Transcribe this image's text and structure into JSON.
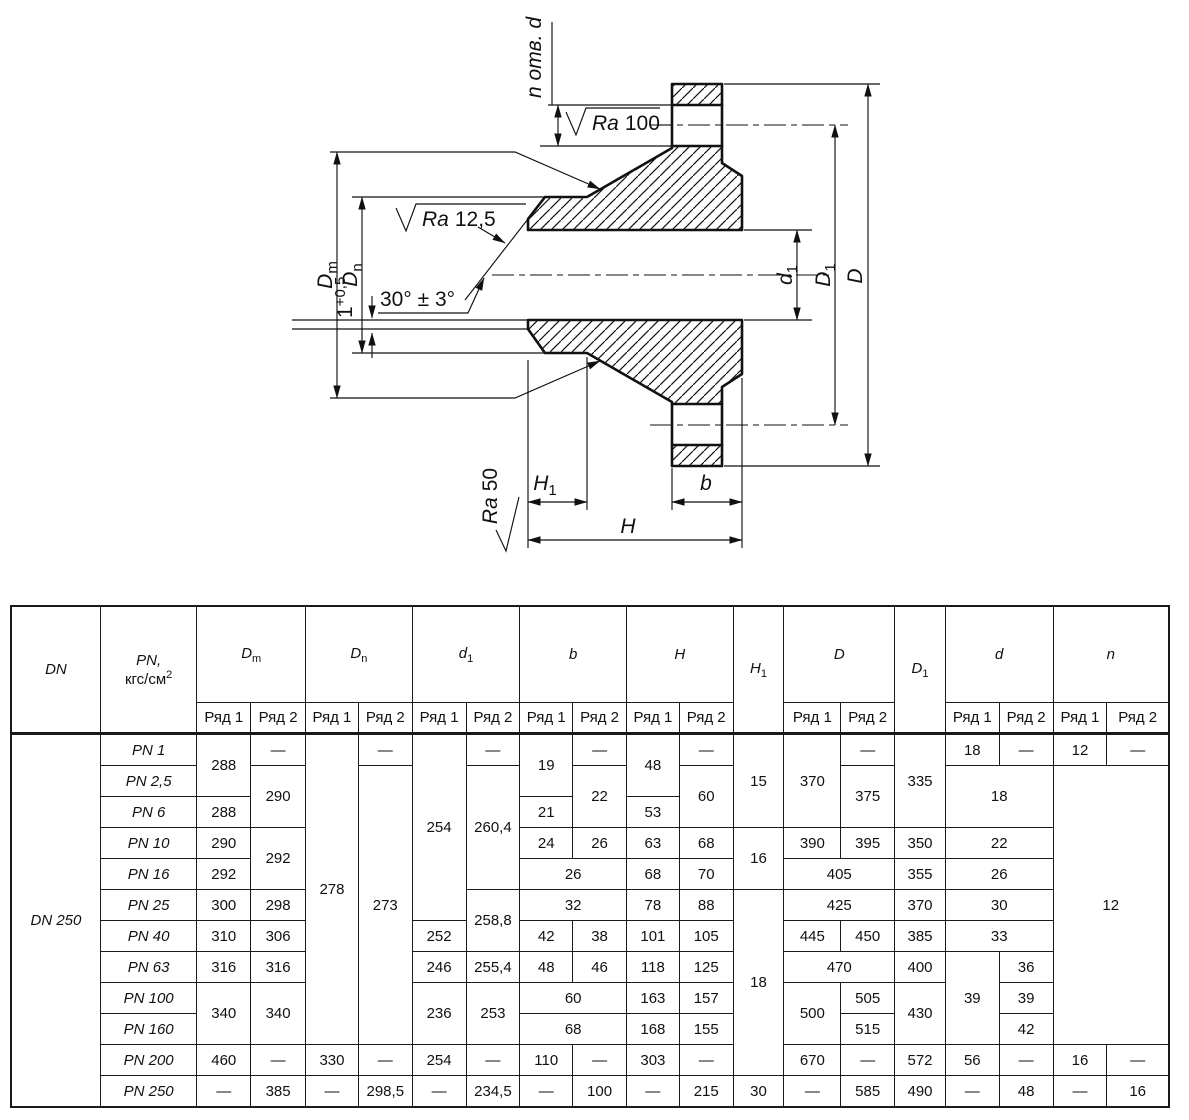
{
  "drawing": {
    "labels": {
      "n_otv_d": "n отв. d",
      "ra_100": {
        "prefix": "Ra",
        "value": "100"
      },
      "ra_12_5": {
        "prefix": "Ra",
        "value": "12,5"
      },
      "ra_50": {
        "prefix": "Ra",
        "value": "50"
      },
      "angle": "30° ± 3°",
      "land": {
        "base": "1",
        "sup": "+0,5"
      },
      "dim_dm": {
        "base": "D",
        "sub": "m"
      },
      "dim_dn": {
        "base": "D",
        "sub": "n"
      },
      "dim_d1": {
        "base": "d",
        "sub": "1"
      },
      "dim_D1": {
        "base": "D",
        "sub": "1"
      },
      "dim_D": "D",
      "dim_H1": {
        "base": "H",
        "sub": "1"
      },
      "dim_H": "H",
      "dim_b": "b"
    }
  },
  "table": {
    "header": {
      "dn": "DN",
      "pn": {
        "base": "PN,",
        "unit": "кгс/см",
        "sup": "2"
      },
      "dm": {
        "base": "D",
        "sub": "m"
      },
      "dnn": {
        "base": "D",
        "sub": "n"
      },
      "d1": {
        "base": "d",
        "sub": "1"
      },
      "b": "b",
      "h": "H",
      "h1": {
        "base": "H",
        "sub": "1"
      },
      "d_big": "D",
      "D1": {
        "base": "D",
        "sub": "1"
      },
      "d_small": "d",
      "n": "n"
    },
    "sub": {
      "r1": "Ряд 1",
      "r2": "Ряд 2"
    },
    "body": [
      [
        {
          "v": "DN 250",
          "rs": 12,
          "cls": "dn"
        },
        {
          "v": "PN 1",
          "cls": "pn"
        },
        {
          "v": "288",
          "rs": 2
        },
        {
          "v": "—"
        },
        {
          "v": "278",
          "rs": 10
        },
        {
          "v": "—"
        },
        {
          "v": "254",
          "rs": 6
        },
        {
          "v": "—"
        },
        {
          "v": "19",
          "rs": 2
        },
        {
          "v": "—"
        },
        {
          "v": "48",
          "rs": 2
        },
        {
          "v": "—"
        },
        {
          "v": "15",
          "rs": 3
        },
        {
          "v": "370",
          "rs": 3
        },
        {
          "v": "—"
        },
        {
          "v": "335",
          "rs": 3
        },
        {
          "v": "18"
        },
        {
          "v": "—"
        },
        {
          "v": "12"
        },
        {
          "v": "—"
        }
      ],
      [
        {
          "v": "PN 2,5",
          "cls": "pn"
        },
        {
          "v": "290",
          "rs": 2
        },
        {
          "v": "273",
          "rs": 9
        },
        {
          "v": "260,4",
          "rs": 4
        },
        {
          "v": "22",
          "rs": 2
        },
        {
          "v": "60",
          "rs": 2
        },
        {
          "v": "375",
          "rs": 2
        },
        {
          "v": "18",
          "rs": 2,
          "cs": 2
        },
        {
          "v": "12",
          "rs": 9,
          "cs": 2
        }
      ],
      [
        {
          "v": "PN 6",
          "cls": "pn"
        },
        {
          "v": "288"
        },
        {
          "v": "21"
        },
        {
          "v": "53"
        }
      ],
      [
        {
          "v": "PN 10",
          "cls": "pn"
        },
        {
          "v": "290"
        },
        {
          "v": "292",
          "rs": 2
        },
        {
          "v": "24"
        },
        {
          "v": "26"
        },
        {
          "v": "63"
        },
        {
          "v": "68"
        },
        {
          "v": "16",
          "rs": 2
        },
        {
          "v": "390"
        },
        {
          "v": "395"
        },
        {
          "v": "350"
        },
        {
          "v": "22",
          "cs": 2
        }
      ],
      [
        {
          "v": "PN 16",
          "cls": "pn"
        },
        {
          "v": "292"
        },
        {
          "v": "26",
          "cs": 2
        },
        {
          "v": "68"
        },
        {
          "v": "70"
        },
        {
          "v": "405",
          "cs": 2
        },
        {
          "v": "355"
        },
        {
          "v": "26",
          "cs": 2
        }
      ],
      [
        {
          "v": "PN 25",
          "cls": "pn"
        },
        {
          "v": "300"
        },
        {
          "v": "298"
        },
        {
          "v": "258,8",
          "rs": 2
        },
        {
          "v": "32",
          "cs": 2
        },
        {
          "v": "78"
        },
        {
          "v": "88"
        },
        {
          "v": "18",
          "rs": 6
        },
        {
          "v": "425",
          "cs": 2
        },
        {
          "v": "370"
        },
        {
          "v": "30",
          "cs": 2
        }
      ],
      [
        {
          "v": "PN 40",
          "cls": "pn"
        },
        {
          "v": "310"
        },
        {
          "v": "306"
        },
        {
          "v": "252"
        },
        {
          "v": "42"
        },
        {
          "v": "38"
        },
        {
          "v": "101"
        },
        {
          "v": "105"
        },
        {
          "v": "445"
        },
        {
          "v": "450"
        },
        {
          "v": "385"
        },
        {
          "v": "33",
          "cs": 2
        }
      ],
      [
        {
          "v": "PN 63",
          "cls": "pn"
        },
        {
          "v": "316"
        },
        {
          "v": "316"
        },
        {
          "v": "246"
        },
        {
          "v": "255,4"
        },
        {
          "v": "48"
        },
        {
          "v": "46"
        },
        {
          "v": "118"
        },
        {
          "v": "125"
        },
        {
          "v": "470",
          "cs": 2
        },
        {
          "v": "400"
        },
        {
          "v": "39",
          "rs": 3
        },
        {
          "v": "36"
        }
      ],
      [
        {
          "v": "PN 100",
          "cls": "pn"
        },
        {
          "v": "340",
          "rs": 2
        },
        {
          "v": "340",
          "rs": 2
        },
        {
          "v": "236",
          "rs": 2
        },
        {
          "v": "253",
          "rs": 2
        },
        {
          "v": "60",
          "cs": 2
        },
        {
          "v": "163"
        },
        {
          "v": "157"
        },
        {
          "v": "500",
          "rs": 2
        },
        {
          "v": "505"
        },
        {
          "v": "430",
          "rs": 2
        },
        {
          "v": "39"
        }
      ],
      [
        {
          "v": "PN 160",
          "cls": "pn"
        },
        {
          "v": "68",
          "cs": 2
        },
        {
          "v": "168"
        },
        {
          "v": "155"
        },
        {
          "v": "515"
        },
        {
          "v": "42"
        }
      ],
      [
        {
          "v": "PN 200",
          "cls": "pn"
        },
        {
          "v": "460"
        },
        {
          "v": "—"
        },
        {
          "v": "330"
        },
        {
          "v": "—"
        },
        {
          "v": "254"
        },
        {
          "v": "—"
        },
        {
          "v": "110"
        },
        {
          "v": "—"
        },
        {
          "v": "303"
        },
        {
          "v": "—"
        },
        {
          "v": "670"
        },
        {
          "v": "—"
        },
        {
          "v": "572"
        },
        {
          "v": "56"
        },
        {
          "v": "—"
        },
        {
          "v": "16"
        },
        {
          "v": "—"
        }
      ],
      [
        {
          "v": "PN 250",
          "cls": "pn"
        },
        {
          "v": "—"
        },
        {
          "v": "385"
        },
        {
          "v": "—"
        },
        {
          "v": "298,5"
        },
        {
          "v": "—"
        },
        {
          "v": "234,5"
        },
        {
          "v": "—"
        },
        {
          "v": "100"
        },
        {
          "v": "—"
        },
        {
          "v": "215"
        },
        {
          "v": "30"
        },
        {
          "v": "—"
        },
        {
          "v": "585"
        },
        {
          "v": "490"
        },
        {
          "v": "—"
        },
        {
          "v": "48"
        },
        {
          "v": "—"
        },
        {
          "v": "16"
        }
      ]
    ]
  }
}
